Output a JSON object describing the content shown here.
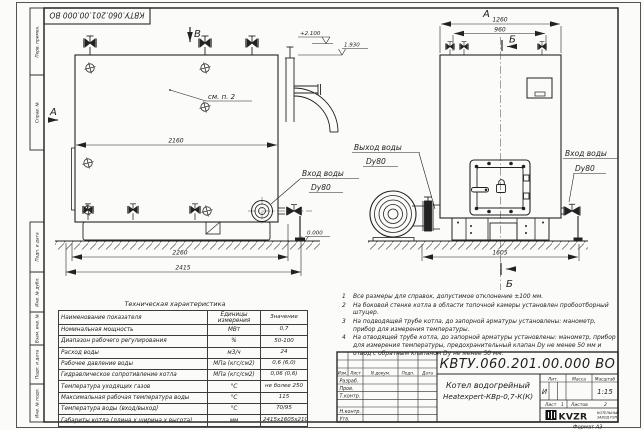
{
  "sheet": {
    "stamp": "КВТУ.060.201.00.000 ВО",
    "format_note": "Формат А3",
    "margin_labels": [
      "Перв. примен.",
      "Справ. №",
      "Подп. и дата",
      "Инв. № дубл.",
      "Взам. инв. №",
      "Подп. и дата",
      "Инв. № подл."
    ]
  },
  "drawing": {
    "section_v": "В",
    "section_a_side": "А",
    "section_a_top": "А",
    "section_b_top": "Б",
    "section_b_bottom": "Б",
    "see_note": "см. п. 2",
    "elev_top": "+2.100",
    "elev_mid": "1.930",
    "elev_zero": "0.000",
    "dim_2160": "2160",
    "dim_2260": "2260",
    "dim_2415": "2415",
    "dim_1260": "1260",
    "dim_960": "960",
    "dim_1605": "1605",
    "outlet_label": "Выход воды",
    "outlet_size": "Dy80",
    "inlet_label_side": "Вход воды",
    "inlet_size_side": "Dy80",
    "inlet_label_front": "Вход воды",
    "inlet_size_front": "Dy80"
  },
  "tech_table": {
    "title": "Техническая характеристика",
    "col_name": "Наименование показателя",
    "col_units_1": "Единицы",
    "col_units_2": "измерения",
    "col_value": "Значение",
    "rows": [
      {
        "name": "Номинальная мощность",
        "units": "МВт",
        "value": "0,7"
      },
      {
        "name": "Диапазон рабочего регулирования",
        "units": "%",
        "value": "50-100"
      },
      {
        "name": "Расход воды",
        "units": "м3/ч",
        "value": "24"
      },
      {
        "name": "Рабочее давление воды",
        "units": "МПа (кгс/см2)",
        "value": "0,6 (6,0)"
      },
      {
        "name": "Гидравлическое сопротивление котла",
        "units": "МПа (кгс/см2)",
        "value": "0,06 (0,6)"
      },
      {
        "name": "Температура уходящих газов",
        "units": "°С",
        "value": "не более 250"
      },
      {
        "name": "Максимальная рабочая температура воды",
        "units": "°С",
        "value": "115"
      },
      {
        "name": "Температура воды (вход/выход)",
        "units": "°С",
        "value": "70/95"
      },
      {
        "name": "Габариты котла (длина х ширина х высота)",
        "units": "мм",
        "value": "2415х1605х2100"
      }
    ]
  },
  "notes": {
    "items": [
      {
        "num": "1",
        "text": "Все размеры для справок, допустимое отклонение ±100 мм."
      },
      {
        "num": "2",
        "text": "На боковой стенке котла в области топочной камеры установлен пробоотборный штуцер."
      },
      {
        "num": "3",
        "text": "На подводящей трубе котла, до запорной арматуры установлены: манометр, прибор для измерения температуры."
      },
      {
        "num": "4",
        "text": "На отводящей трубе котла, до запорной арматуры установлены: манометр, прибор для измерения температуры, предохранительный клапан Dу не менее 50 мм и отвод с обратным клапаном Dу не менее 50 мм."
      }
    ]
  },
  "title_block": {
    "doc_number": "КВТУ.060.201.00.000 ВО",
    "col_izm": "Изм.",
    "col_list": "Лист",
    "col_doc": "N докум.",
    "col_podp": "Подп.",
    "col_data": "Дата",
    "row_razrab": "Разраб.",
    "row_prov": "Пров.",
    "row_tkontr": "Т.контр.",
    "row_nkontr": "Н.контр.",
    "row_utv": "Утв.",
    "product_line1": "Котел водогрейный",
    "product_line2": "Heatexpert-КВр-0,7-К(К)",
    "lit_label": "Лит.",
    "mass_label": "Масса",
    "scale_label": "Масштаб",
    "lit_value": "И",
    "scale_value": "1:15",
    "sheet_label": "Лист",
    "sheet_value": "1",
    "sheets_label": "Листов",
    "sheets_value": "2",
    "logo_text": "KVZR",
    "logo_sub1": "КОТЕЛЬНЫЙ",
    "logo_sub2": "ЗАВОД РЭП"
  }
}
